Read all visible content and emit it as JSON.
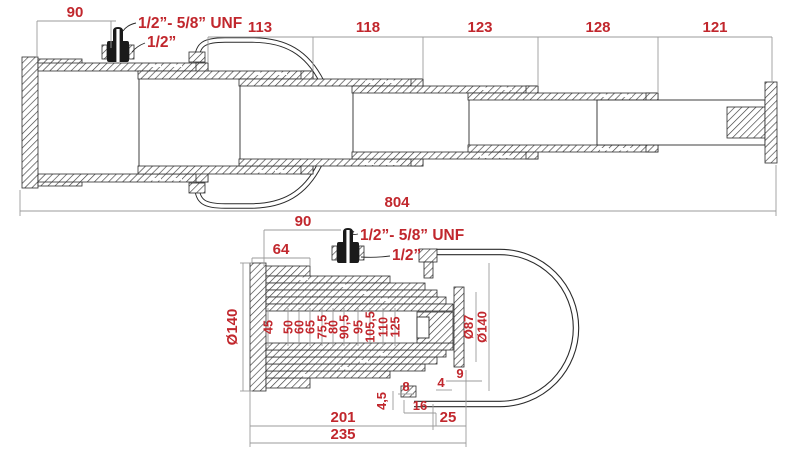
{
  "ext": {
    "dim_90": "90",
    "chain": [
      "113",
      "118",
      "123",
      "128",
      "121"
    ],
    "overall": "804",
    "unf_label": "1/2”- 5/8” UNF",
    "half_label": "1/2”"
  },
  "ret": {
    "dim_90": "90",
    "dim_64": "64",
    "unf_label": "1/2”- 5/8” UNF",
    "half_label": "1/2”",
    "dia_left": "Ø140",
    "bores": [
      "45",
      "50",
      "60",
      "65",
      "75,5",
      "80",
      "90,5",
      "95",
      "105,5",
      "110",
      "125"
    ],
    "dia_rod": "Ø87",
    "dia_flange": "Ø140",
    "d9": "9",
    "d4": "4",
    "d8": "8",
    "d45": "4,5",
    "d16": "16",
    "d25": "25",
    "body": "201",
    "total": "235"
  },
  "colors": {
    "dimension_text": "#c1272d",
    "drawing_line": "#2b2b2b",
    "dim_line": "#9b9b9b",
    "background": "#ffffff"
  }
}
